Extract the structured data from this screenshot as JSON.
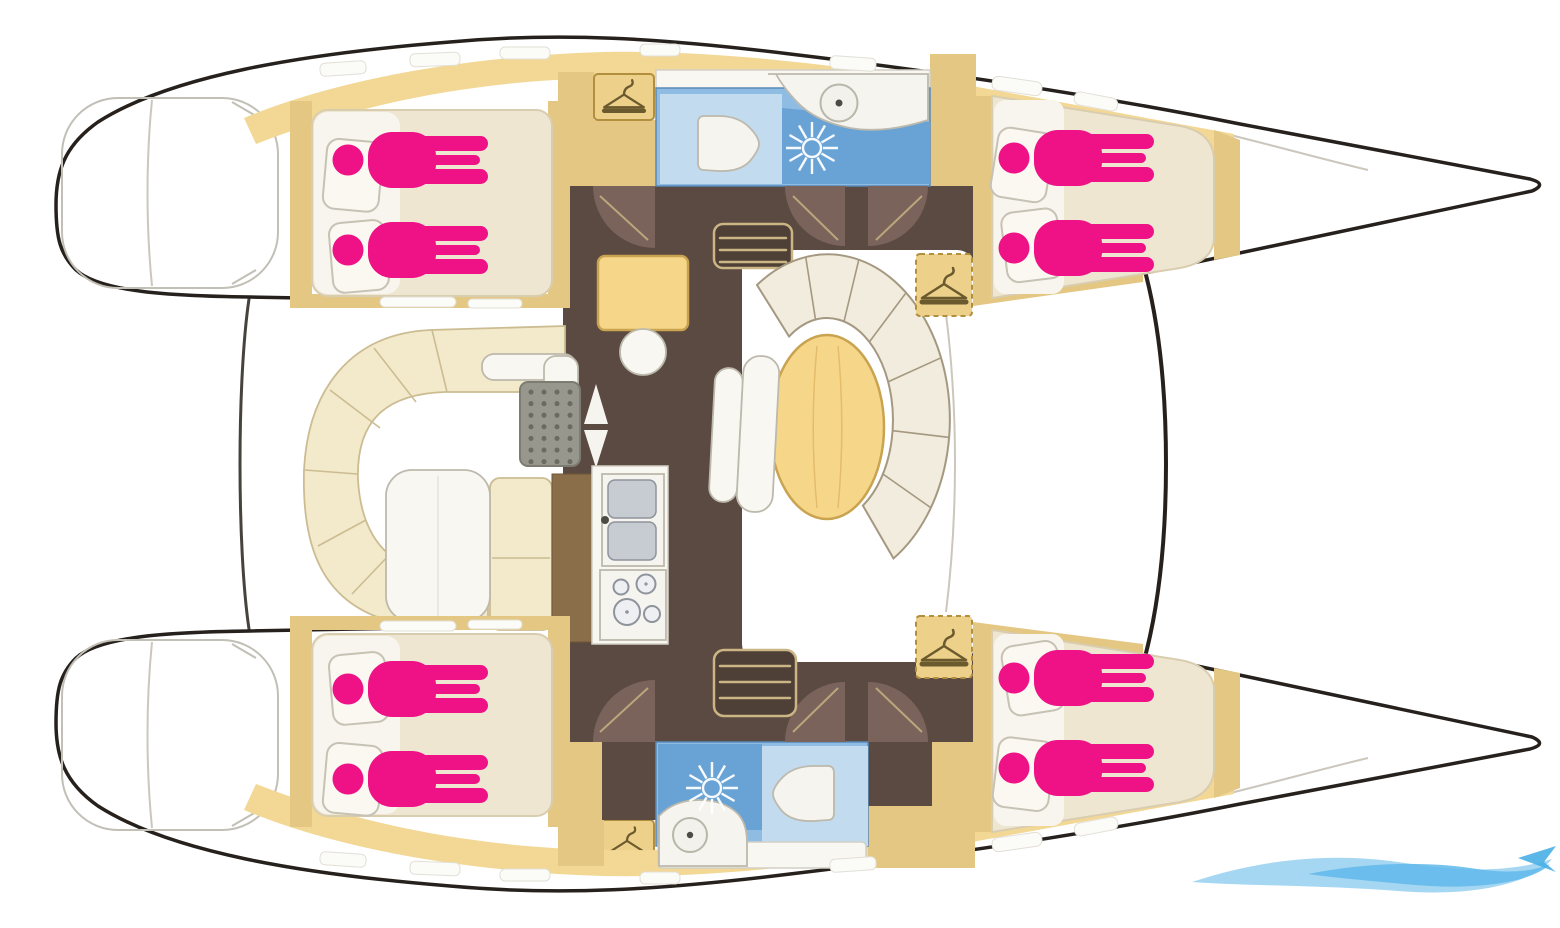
{
  "diagram": {
    "type": "boat-floor-plan",
    "subject": "Sailing catamaran accommodation layout, top-down deck plan",
    "orientation": {
      "bow": "right",
      "stern": "left",
      "port_hull": "top",
      "starboard_hull": "bottom"
    },
    "capacity": {
      "cabins": 4,
      "berths": 8,
      "heads": 2,
      "occupants_shown": 8
    },
    "cabins": [
      {
        "label": "Port aft double cabin",
        "berths": 2,
        "occupants_shown": 2,
        "position": "top-left",
        "features": [
          "double berth",
          "two pillows",
          "hull windows"
        ]
      },
      {
        "label": "Port forward double cabin",
        "berths": 2,
        "occupants_shown": 2,
        "position": "top-right",
        "features": [
          "tapered double berth",
          "two pillows",
          "hull windows"
        ]
      },
      {
        "label": "Starboard aft double cabin",
        "berths": 2,
        "occupants_shown": 2,
        "position": "bottom-left",
        "features": [
          "double berth",
          "two pillows",
          "hull windows"
        ]
      },
      {
        "label": "Starboard forward double cabin",
        "berths": 2,
        "occupants_shown": 2,
        "position": "bottom-right",
        "features": [
          "tapered double berth",
          "two pillows",
          "hull windows"
        ]
      }
    ],
    "heads": [
      {
        "label": "Port head compartment",
        "position": "top-center",
        "fixtures": [
          "toilet",
          "shower",
          "washbasin vanity"
        ]
      },
      {
        "label": "Starboard head compartment",
        "position": "bottom-center",
        "fixtures": [
          "shower",
          "toilet",
          "washbasin vanity"
        ]
      }
    ],
    "saloon": {
      "label": "Saloon on bridge deck",
      "features": [
        "chart table with stool",
        "curved wrap-around settee",
        "oval dining table",
        "two bench seats",
        "galley with double sink",
        "stove with four burners",
        "companionway steps to each hull",
        "door swings",
        "wardrobes"
      ]
    },
    "cockpit": {
      "label": "Aft cockpit",
      "features": [
        "C-shaped bench seating",
        "cockpit table",
        "side bench",
        "deck grate",
        "entry direction arrows"
      ]
    },
    "exterior": {
      "features": [
        "twin bows with forward crossbeam",
        "stern swim platforms",
        "side decks with hatches"
      ]
    },
    "wardrobes_shown": 4,
    "icon_legend": {
      "berth-occupant-icon": "magenta person silhouette = one berth place",
      "hanger-icon": "clothes hanger = wardrobe / hanging locker",
      "shower-icon": "white spray starburst = shower",
      "toilet-icon": "white rounded bowl = marine toilet",
      "washbasin-icon": "circle with center drain = washbasin",
      "arrow-icons": "up/down arrows = companionway entry"
    }
  },
  "watermark": {
    "position": "bottom-right",
    "style": "light blue wave swoosh logo"
  },
  "palette": {
    "outline": "#26211C",
    "deckTan": "#F2D795",
    "wallTan": "#E3C783",
    "wardrobeTan": "#EDD089",
    "wardrobeEdge": "#B28F3E",
    "benchCream": "#F3EACB",
    "benchEdge": "#CBBC92",
    "berthCream": "#EFE6D2",
    "berthEdge": "#D9CDB0",
    "sheetWhite": "#F7F5EE",
    "setteeCream": "#F1ECDD",
    "setteeEdge": "#A59880",
    "floorDark": "#5B4A41",
    "floorDeep": "#4E3F37",
    "doorArc": "#7A635A",
    "wood": "#8A6E49",
    "woodEdge": "#6F5737",
    "tableYellow": "#F6D78A",
    "tableEdge": "#C9A34F",
    "tableGrain": "#E3BC6C",
    "pink": "#EE1286",
    "bathMid": "#8FBCE3",
    "bathLight": "#C2DBEF",
    "bathDeep": "#69A3D6",
    "bathEdge": "#5B89B8",
    "offWhite": "#F8F7F2",
    "fixtureWhite": "#F6F4EF",
    "greyEdge": "#BDB9AC",
    "basinFill": "#F2F1EB",
    "basinEdge": "#B9B6AA",
    "steel": "#C7CBD2",
    "steelEdge": "#8E939C",
    "burnerFill": "#EDEFF2",
    "grate": "#98978D",
    "grateEdge": "#7D7C72",
    "grateDot": "#6C6B61",
    "stepTan": "#CBB584",
    "fineLine": "#CBC7BD",
    "sternLine": "#C2BFB6",
    "pillowWhite": "#FAF8F1",
    "pillowEdge": "#C6C2B4",
    "windowWhite": "#FBFBF8",
    "windowEdge": "#E2DFD5",
    "arrowWhite": "#F6F4EE",
    "hangerInk": "#6B5A2E",
    "counterEdge": "#D2CFC5",
    "waveBlue": "#8FCDF0",
    "waveDeep": "#5FB8EA",
    "waveDart": "#49AFE6"
  }
}
